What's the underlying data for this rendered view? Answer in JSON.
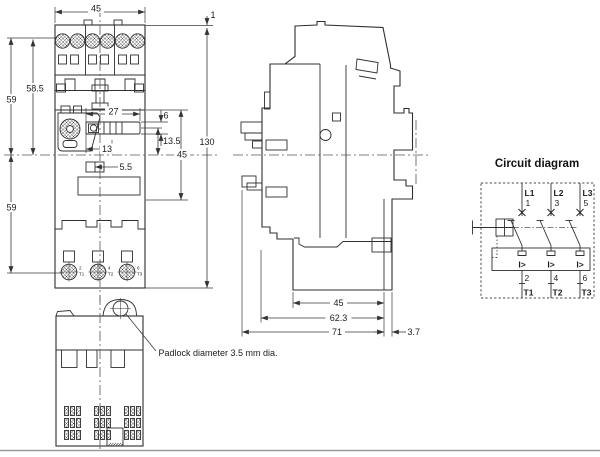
{
  "front_view": {
    "dims": {
      "top_width": "45",
      "top_offset": "1",
      "total_height": "130",
      "left_upper": "59",
      "left_upper_inner": "58.5",
      "left_lower": "59",
      "slider_width": "27",
      "window_height": "6",
      "window_to_center": "13.5",
      "mid_section": "45",
      "slider_to_center": "13",
      "small_window": "5.5"
    },
    "bottom_terminals": [
      {
        "num": "2",
        "load": "T1"
      },
      {
        "num": "4",
        "load": "T2"
      },
      {
        "num": "6",
        "load": "T3"
      }
    ]
  },
  "side_view": {
    "dims": {
      "body_depth": "45",
      "mid_depth": "62.3",
      "total_depth": "71",
      "rear_offset": "3.7"
    }
  },
  "bottom_view": {
    "padlock_note": "Padlock diameter 3.5 mm dia."
  },
  "circuit_diagram": {
    "title": "Circuit diagram",
    "overload_symbol": "I>",
    "poles": [
      {
        "line": "L1",
        "top_terminal": "1",
        "bottom_terminal": "2",
        "load_terminal": "T1"
      },
      {
        "line": "L2",
        "top_terminal": "3",
        "bottom_terminal": "4",
        "load_terminal": "T2"
      },
      {
        "line": "L3",
        "top_terminal": "5",
        "bottom_terminal": "6",
        "load_terminal": "T3"
      }
    ]
  },
  "colors": {
    "line": "#2f2f2f",
    "dimension": "#3a3a3a",
    "page_rule": "#9a9a9a",
    "background": "#ffffff"
  }
}
